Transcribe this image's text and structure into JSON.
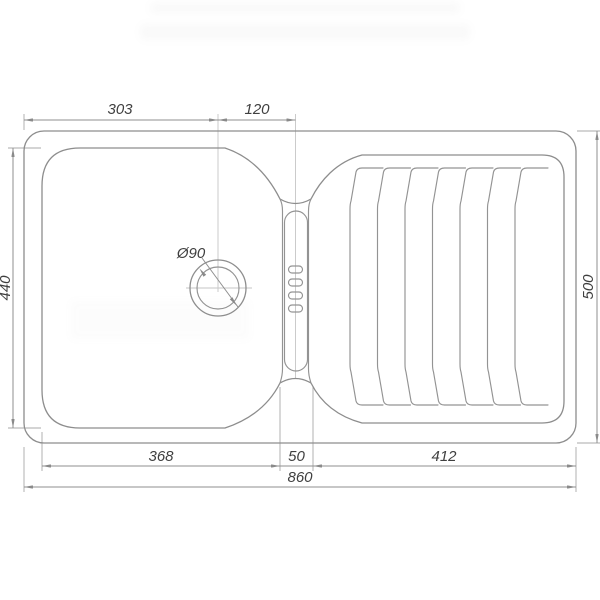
{
  "page": {
    "background": "#ffffff"
  },
  "drawing": {
    "subject": "kitchen-sink-top-view-technical-drawing",
    "line_color": "#8d8d8d",
    "dimension_line_color": "#8f8f8f",
    "text_color": "#3f3f3f",
    "labels": {
      "top_width_left": "303",
      "top_width_right": "120",
      "left_height": "440",
      "right_height": "500",
      "bottom_bowl_width": "368",
      "bottom_channel_width": "50",
      "bottom_drainboard_width": "412",
      "bottom_overall_width": "860",
      "drain_diameter": "Ø90"
    },
    "features": {
      "drainboard_groove_count": 7,
      "overflow_slot_count": 4,
      "drain_circle_count": 2
    }
  }
}
